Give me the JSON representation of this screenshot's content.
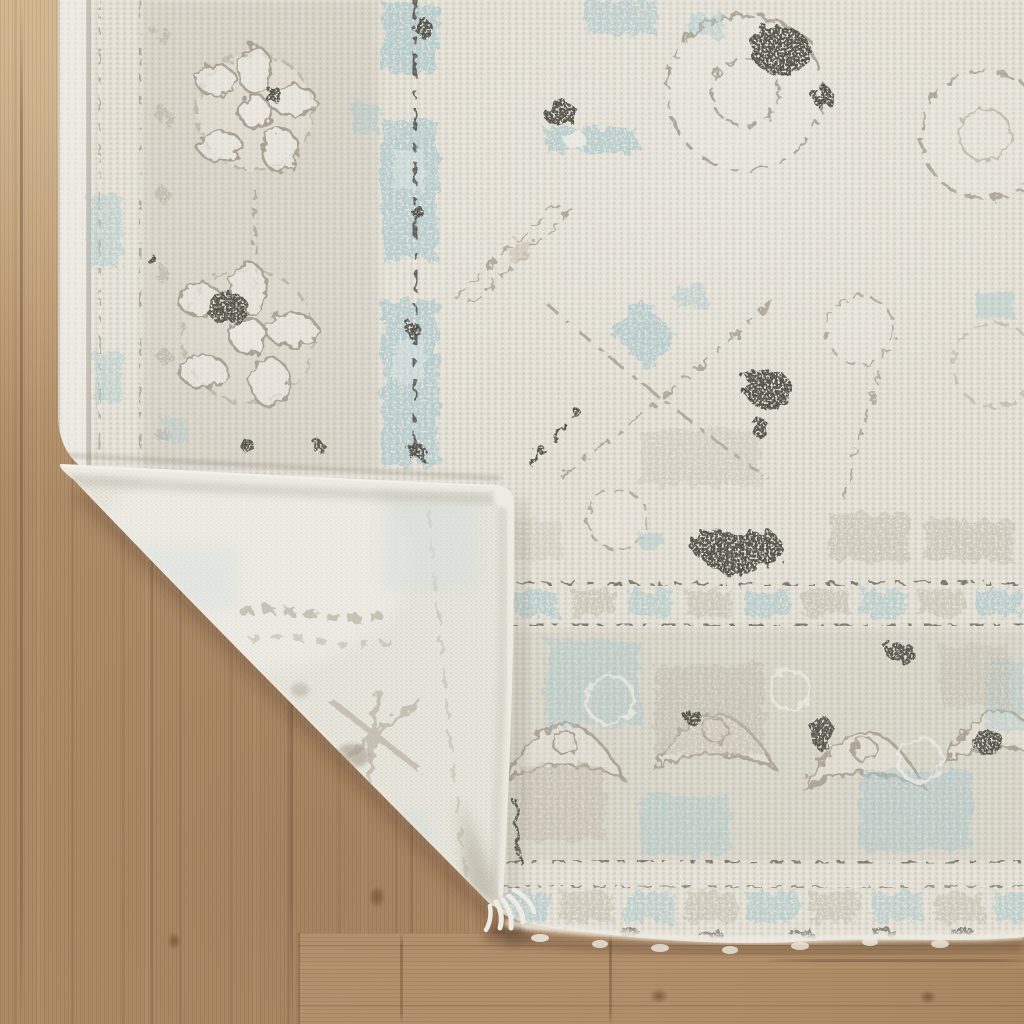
{
  "scene": {
    "type": "product-photo",
    "description": "Corner of a distressed vintage-style ivory, gray and light-blue oriental area rug with its corner folded back to reveal the woven underside, lying on a light oak plank floor",
    "elements": [
      "wood plank floor",
      "area rug with distressed floral pattern",
      "ornate side and bottom borders",
      "folded-back corner",
      "pale woven rug underside",
      "white corner fringe"
    ]
  },
  "colors": {
    "wood_base": "#b28d66",
    "wood_light": "#cbac82",
    "wood_dark": "#7f5f3d",
    "rug_ivory": "#e7e3d8",
    "rug_ivory_hi": "#f2efe7",
    "rug_gray": "#a39c8e",
    "rug_gray_light": "#bfb9ab",
    "rug_taupe": "#8f897b",
    "rug_blue": "#a7cbd1",
    "rug_blue_light": "#cfe0e2",
    "rug_charcoal": "#3c3a33",
    "rug_charcoal_soft": "#56544a",
    "back_base": "#eae7dc",
    "back_smudge": "#b9b3a3",
    "back_blue": "#d8e3e1",
    "back_shadow": "#a39d8d",
    "fringe": "#f3f0e7"
  }
}
